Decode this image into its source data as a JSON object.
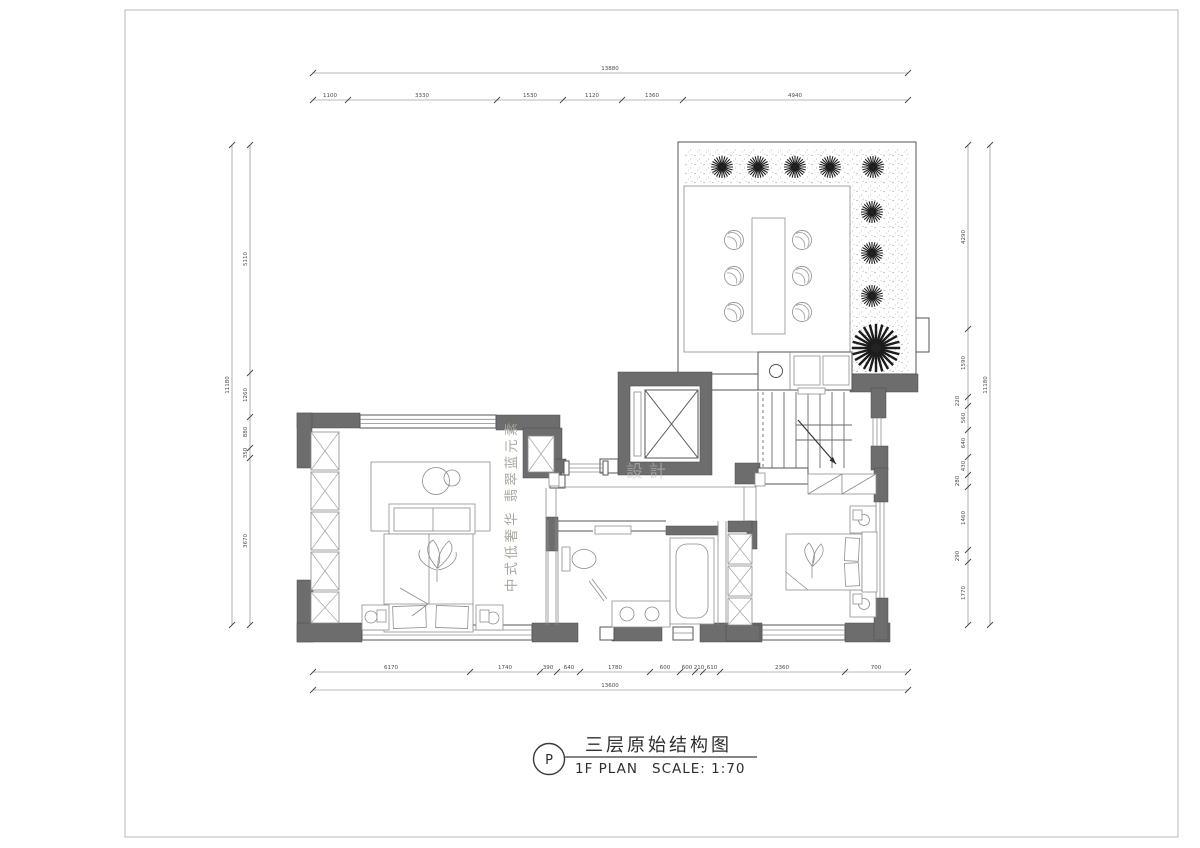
{
  "title_block": {
    "bubble": "P",
    "title": "三层原始结构图",
    "plan_label": "1F PLAN",
    "scale_label": "SCALE: 1:70"
  },
  "watermark": {
    "style_text": "中式低奢华  翡翠蓝元素",
    "brand_text": "設計"
  },
  "dims": {
    "top": {
      "total": "13880",
      "segments": [
        "1100",
        "3330",
        "1530",
        "1120",
        "1360",
        "4940"
      ]
    },
    "bottom": {
      "total": "13600",
      "segments": [
        "6170",
        "1740",
        "390",
        "640",
        "1780",
        "600",
        "600",
        "210",
        "610",
        "2360",
        "700"
      ]
    },
    "left": {
      "total": "11180",
      "segments": [
        "5110",
        "1260",
        "880",
        "350",
        "3670"
      ]
    },
    "right": {
      "total": "11180",
      "segments": [
        "4290",
        "1590",
        "220",
        "560",
        "640",
        "430",
        "280",
        "1460",
        "290",
        "1770"
      ]
    }
  },
  "colors": {
    "wall": "#6d6d6d",
    "line": "#555555",
    "dim_text": "#4a4a4a",
    "watermark": "#a9a89f",
    "paper": "#ffffff"
  }
}
